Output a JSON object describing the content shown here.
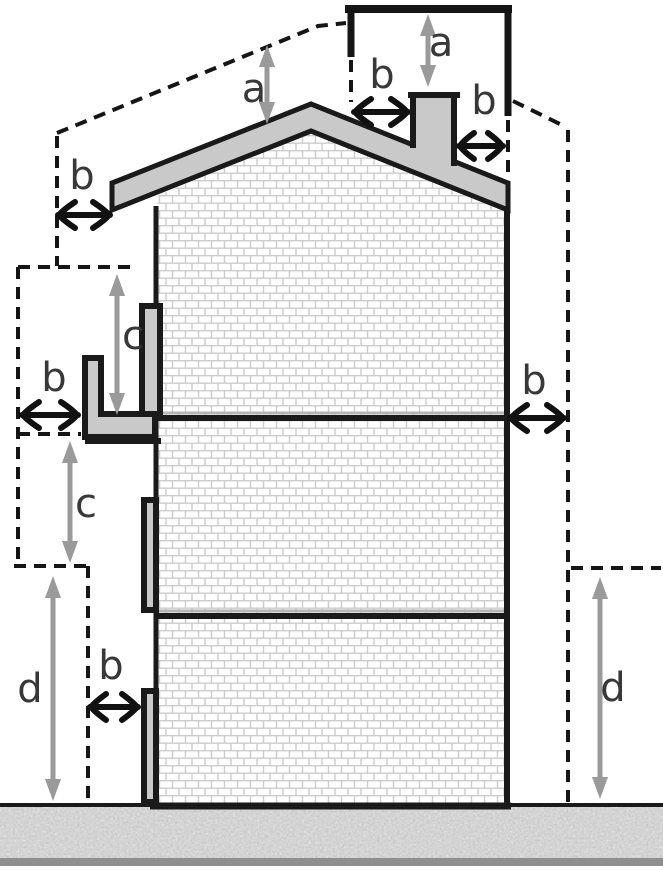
{
  "diagram": {
    "type": "building-clearance-cross-section",
    "labels": {
      "ridge_clearance": "a",
      "chimney_clearance": "a",
      "chimney_left": "b",
      "chimney_right": "b",
      "eave_left": "b",
      "balcony_side": "b",
      "facade_right": "b",
      "window_side": "b",
      "window_above": "c",
      "balcony_below": "c",
      "ground_left": "d",
      "ground_right": "d"
    },
    "colors": {
      "outline": "#1a1a1a",
      "structure_fill": "#c9c9c9",
      "dimension_arrow": "#9a9a9a",
      "brick_joint": "#cccccc",
      "ground_base": "#e3e3e3",
      "ground_bar": "#8f8f8f",
      "label_text": "#383838"
    }
  }
}
